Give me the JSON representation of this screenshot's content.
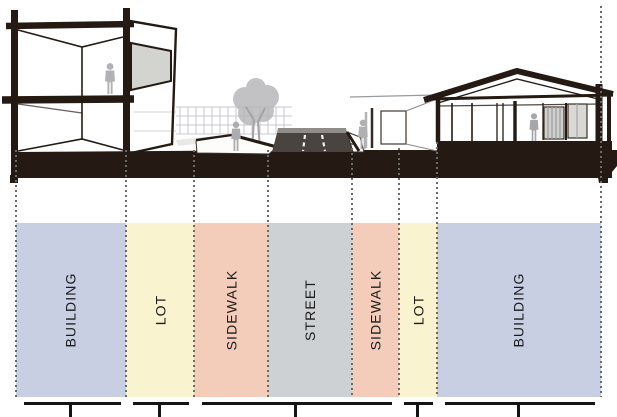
{
  "diagram": {
    "zones": [
      {
        "id": "building-left",
        "label": "BUILDING",
        "color": "#c8cfe3"
      },
      {
        "id": "lot-left",
        "label": "LOT",
        "color": "#faf3cf"
      },
      {
        "id": "sidewalk-left",
        "label": "SIDEWALK",
        "color": "#f3ccba"
      },
      {
        "id": "street",
        "label": "STREET",
        "color": "#ced1d3"
      },
      {
        "id": "sidewalk-right",
        "label": "SIDEWALK",
        "color": "#f3ccba"
      },
      {
        "id": "lot-right",
        "label": "LOT",
        "color": "#faf3cf"
      },
      {
        "id": "building-right",
        "label": "BUILDING",
        "color": "#c8cfe3"
      }
    ],
    "colors": {
      "ink": "#241a13",
      "road_surface": "#494440",
      "sketch_gray": "#b3b3b6",
      "panel_gray": "#d3d3d0",
      "dashed_line": "#6a6a6a",
      "bracket": "#141414",
      "label_text": "#1b1b1b"
    }
  }
}
